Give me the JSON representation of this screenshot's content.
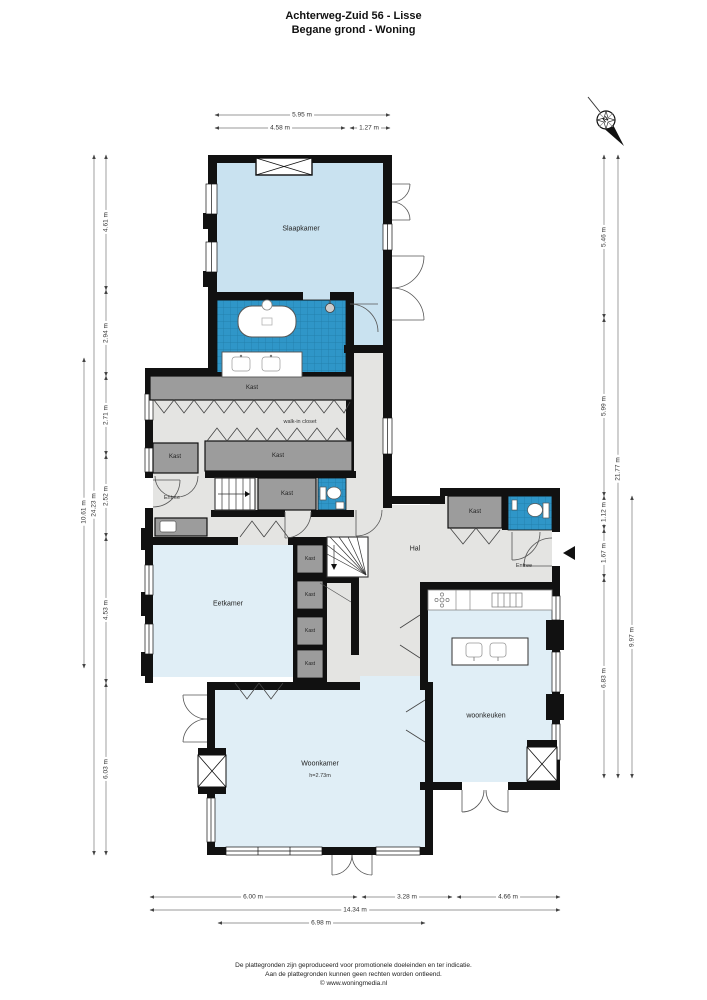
{
  "header": {
    "title": "Achterweg-Zuid 56 - Lisse",
    "subtitle": "Begane grond - Woning"
  },
  "compass": {
    "north_label": "N"
  },
  "labels": {
    "slaapkamer": "Slaapkamer",
    "kast": "Kast",
    "walk_in_closet": "walk-in closet",
    "entree": "Entree",
    "hal": "Hal",
    "eetkamer": "Eetkamer",
    "woonkamer": "Woonkamer",
    "woonkamer_height": "h=2.73m",
    "woonkeuken": "woonkeuken"
  },
  "dimensions": {
    "top": {
      "total": "5.95 m",
      "left": "4.58 m",
      "right": "1.27 m"
    },
    "left": {
      "segments": [
        "4.61 m",
        "2.94 m",
        "2.71 m",
        "2.52 m",
        "4.53 m",
        "6.03 m"
      ],
      "overall": "24.23 m",
      "partial": "10.61 m"
    },
    "right": {
      "segments": [
        "5.46 m",
        "5.99 m",
        "1.12 m",
        "1.67 m",
        "6.83 m"
      ],
      "overall": "21.77 m",
      "partial": "9.97 m"
    },
    "bottom": {
      "segments": [
        "6.00 m",
        "3.28 m",
        "4.66 m"
      ],
      "total": "14.34 m",
      "partial": "6.98 m"
    }
  },
  "footer": {
    "line1": "De plattegronden zijn geproduceerd voor promotionele doeleinden en ter indicatie.",
    "line2": "Aan de plattegronden kunnen geen rechten worden ontleend.",
    "line3": "© www.woningmedia.nl"
  },
  "colors": {
    "wall": "#111111",
    "bedroom_blue": "#c9e2f0",
    "room_blue": "#e0eef6",
    "tile_blue": "#2f96c8",
    "floor_gray": "#e4e4e2",
    "closet_gray": "#9c9c9c"
  }
}
